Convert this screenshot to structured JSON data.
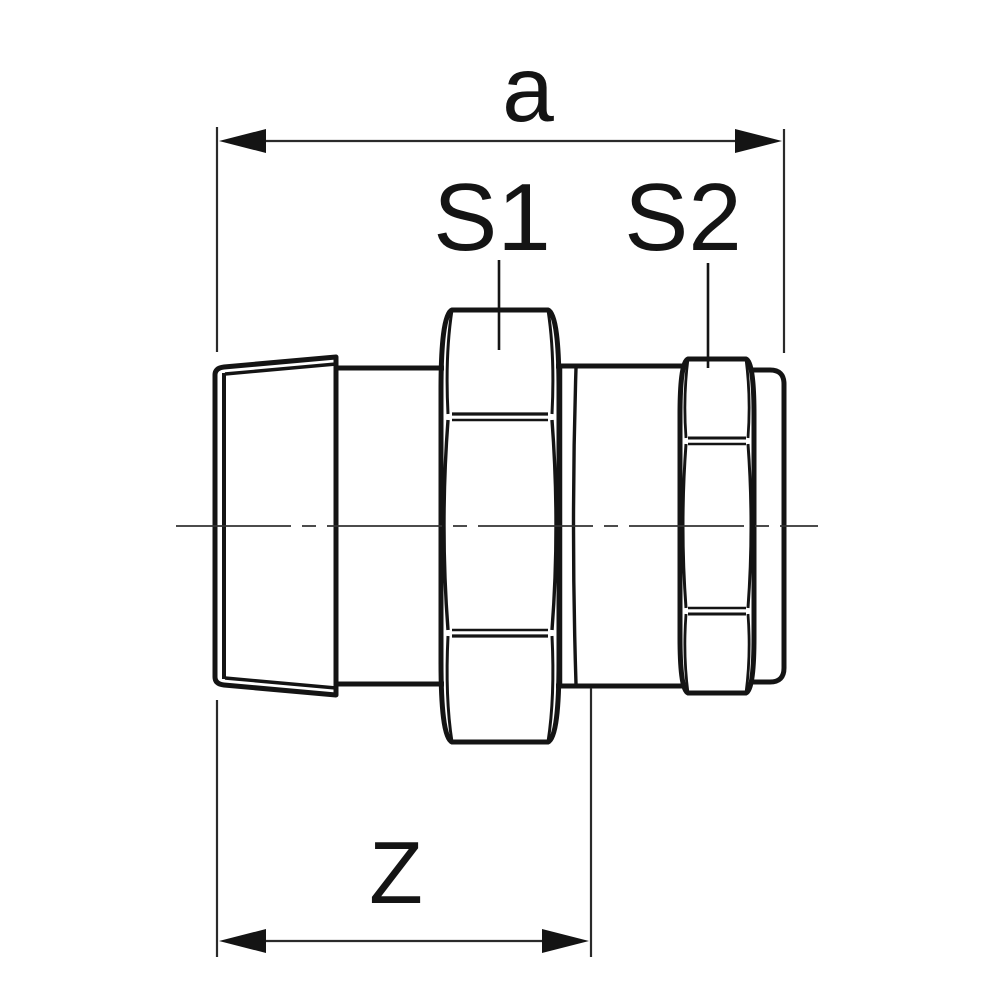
{
  "labels": {
    "dim_a": "a",
    "s1": "S1",
    "s2": "S2",
    "dim_z": "Z"
  },
  "colors": {
    "line": "#141414",
    "dim_line": "#2a2a2a",
    "centerline": "#333333",
    "background": "#ffffff"
  }
}
